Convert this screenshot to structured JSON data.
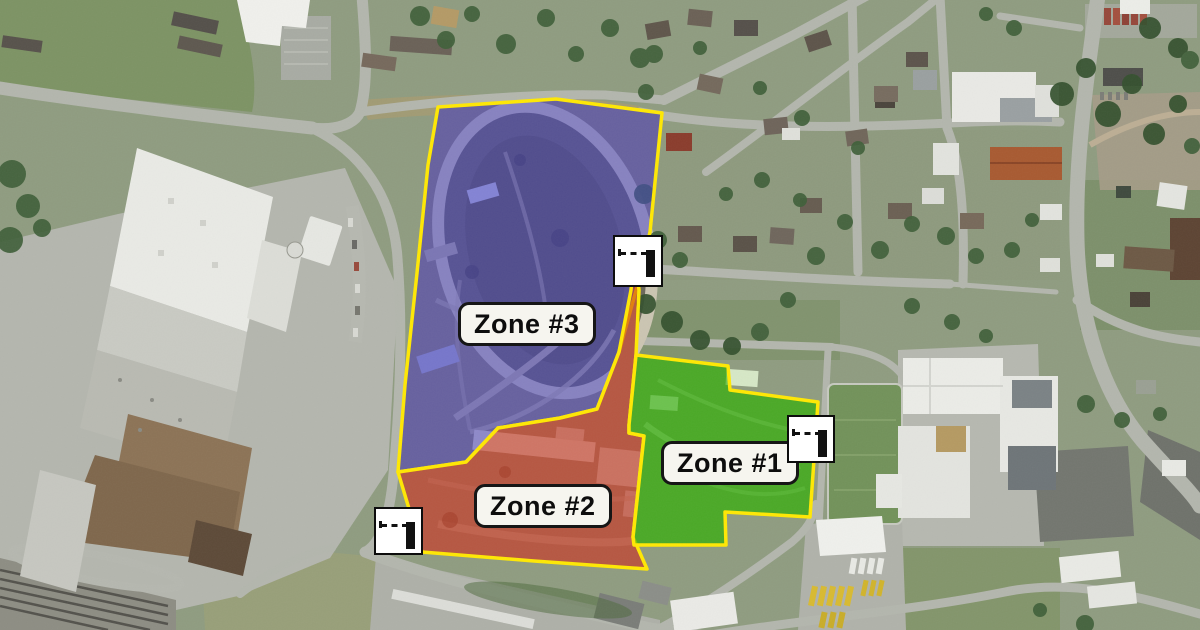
{
  "map": {
    "type": "satellite-aerial",
    "description": "Aerial satellite view with three highlighted event zones around a racetrack and fairgrounds",
    "zone_border_color": "#FFE803",
    "zones": [
      {
        "id": "zone-1",
        "label": "Zone #1",
        "fill_color": "#2FAF0A",
        "fill_opacity": 0.62
      },
      {
        "id": "zone-2",
        "label": "Zone #2",
        "fill_color": "#C62816",
        "fill_opacity": 0.55
      },
      {
        "id": "zone-3",
        "label": "Zone #3",
        "fill_color": "#4340CE",
        "fill_opacity": 0.5
      }
    ],
    "label_style": {
      "background": "#F6F5EF",
      "border_color": "#161616",
      "text_color": "#0D0D0D"
    },
    "markers": [
      {
        "id": "gate-marker-1",
        "icon": "gate-icon",
        "x": 613,
        "y": 235,
        "width": 50,
        "height": 52
      },
      {
        "id": "gate-marker-2",
        "icon": "gate-icon",
        "x": 787,
        "y": 415,
        "width": 48,
        "height": 48
      },
      {
        "id": "gate-marker-3",
        "icon": "gate-icon",
        "x": 374,
        "y": 507,
        "width": 49,
        "height": 48
      }
    ]
  }
}
